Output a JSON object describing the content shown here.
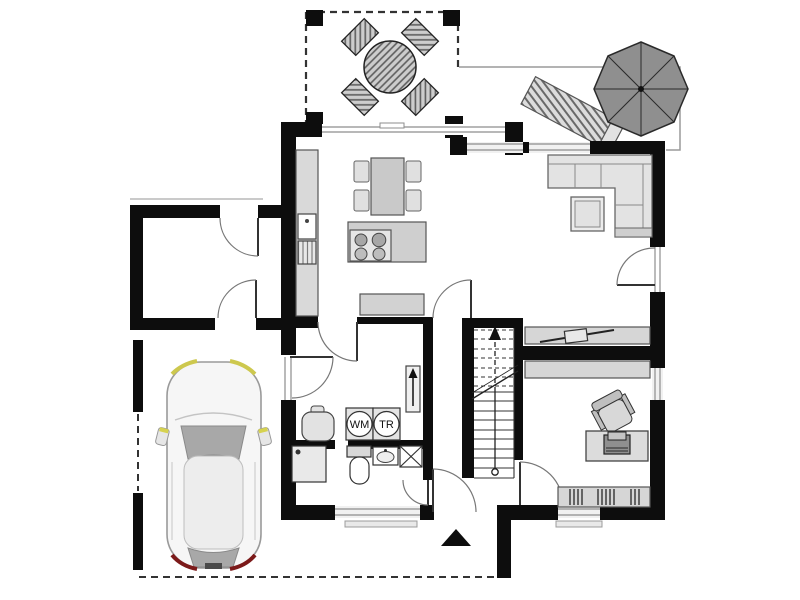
{
  "page": {
    "kind": "floor-plan",
    "view": "top-down ground floor"
  },
  "labels": {
    "washing_machine": "WM",
    "dryer": "TR"
  },
  "colors": {
    "wall": "#111111",
    "furniture_fill": "#d6d6d6",
    "furniture_stroke": "#555555",
    "sofa_fill": "#e3e3e3",
    "parasol": "#8f8f8f",
    "car_body": "#f6f6f6",
    "glass": "#a8a8a8",
    "headlight": "#cdc84e",
    "taillight": "#7c1a1a",
    "dashed_outline": "#333333"
  },
  "objects": [
    "terrace-table-set",
    "parasol",
    "sun-lounger",
    "corner-sofa",
    "coffee-table",
    "tv-lowboard",
    "dining-table",
    "kitchen-island-cooktop",
    "kitchen-counter",
    "sink",
    "dishwasher",
    "sideboard",
    "stairs",
    "washing-machine",
    "dryer",
    "laundry-basket",
    "shower",
    "toilet",
    "washbasin",
    "shaft",
    "desk",
    "office-chair",
    "office-sideboard",
    "bookshelf",
    "car",
    "entrance-arrow"
  ]
}
